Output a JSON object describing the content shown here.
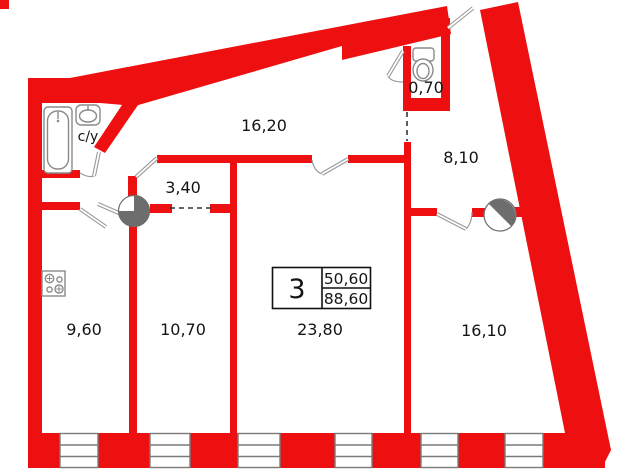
{
  "plan": {
    "kind": "apartment-floor-plan",
    "wall_color": "#ee1010",
    "shaft_fill": "#6d6d6d",
    "fixture_stroke": "#8a8a8a",
    "text_color": "#141414"
  },
  "rooms": [
    {
      "id": "corridor",
      "area": "16,20"
    },
    {
      "id": "wc",
      "area": "0,70"
    },
    {
      "id": "hall",
      "area": "8,10"
    },
    {
      "id": "inner-corridor",
      "area": "3,40"
    },
    {
      "id": "kitchen",
      "area": "9,60"
    },
    {
      "id": "room-a",
      "area": "10,70"
    },
    {
      "id": "room-b",
      "area": "23,80"
    },
    {
      "id": "room-c",
      "area": "16,10"
    },
    {
      "id": "bathroom",
      "label": "с/у"
    }
  ],
  "info_box": {
    "rooms_count": "3",
    "living_area": "50,60",
    "total_area": "88,60"
  },
  "fixtures": [
    {
      "id": "bathtub-icon"
    },
    {
      "id": "sink-icon"
    },
    {
      "id": "toilet-icon"
    },
    {
      "id": "stove-icon"
    },
    {
      "id": "vent-shaft-left-icon"
    },
    {
      "id": "vent-shaft-right-icon"
    }
  ]
}
